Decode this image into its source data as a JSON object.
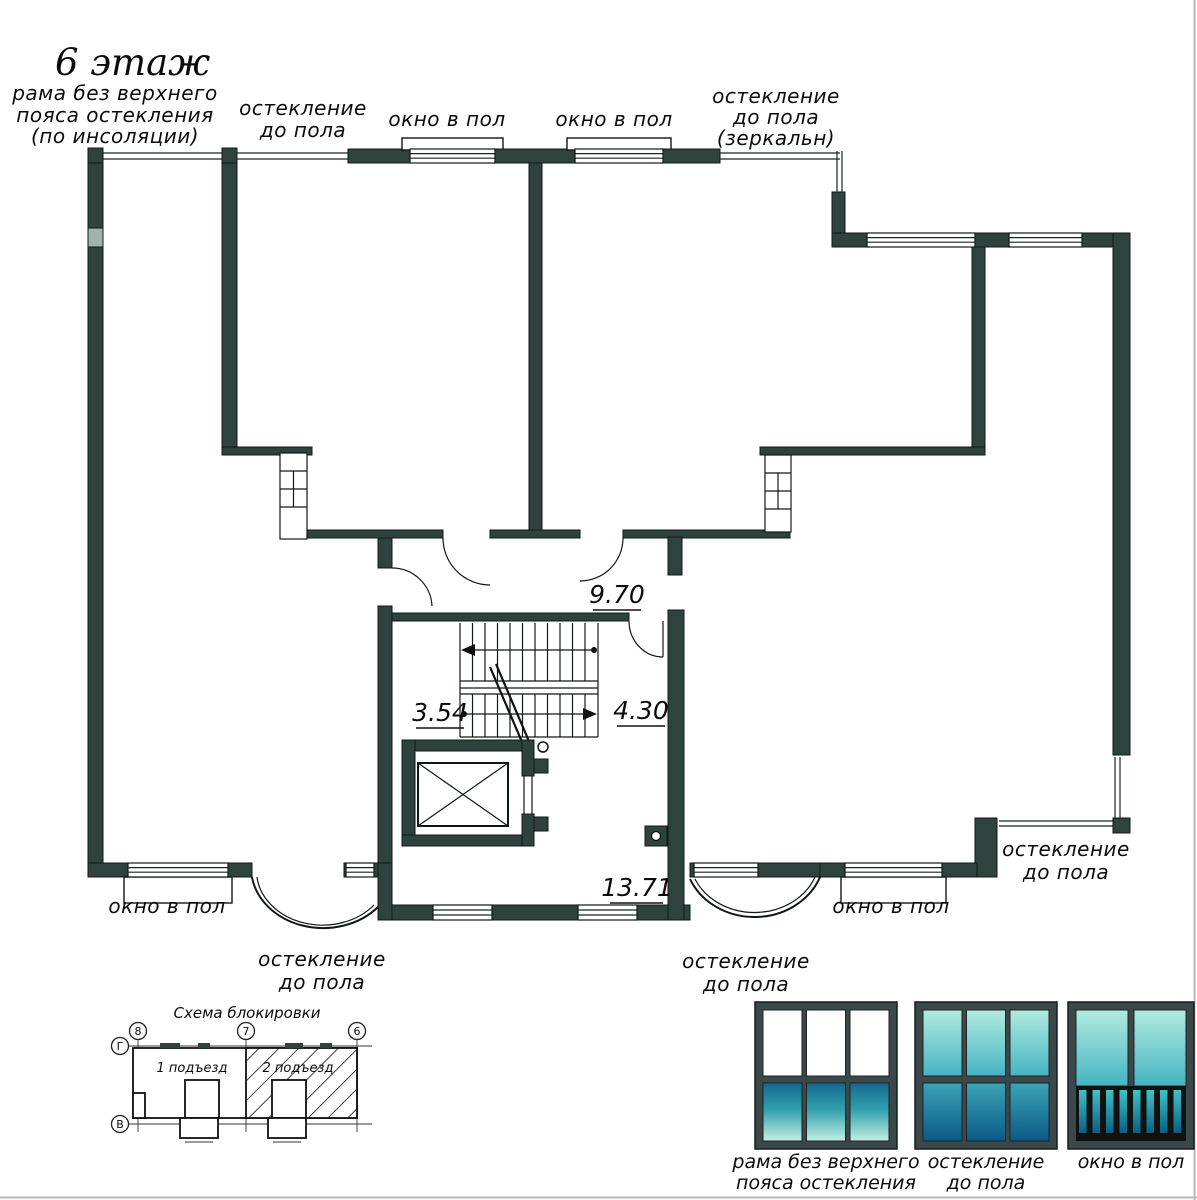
{
  "drawing": {
    "floor_title": "6 этаж",
    "annotations": {
      "frame_no_upper_belt": {
        "line1": "рама без верхнего",
        "line2": "пояса остекления",
        "line3": "(по инсоляции)"
      },
      "glazing_top_left": {
        "line1": "остекление",
        "line2": "до пола"
      },
      "window_top_left": "окно в пол",
      "window_top_right": "окно в пол",
      "glazing_mirror": {
        "line1": "остекление",
        "line2": "до пола",
        "line3": "(зеркальн)"
      },
      "window_bottom_left": "окно в пол",
      "glazing_bay_left": {
        "line1": "остекление",
        "line2": "до пола"
      },
      "glazing_bay_right": {
        "line1": "остекление",
        "line2": "до пола"
      },
      "glazing_corner_right": {
        "line1": "остекление",
        "line2": "до пола"
      },
      "window_bottom_right": "окно в пол"
    },
    "room_dimensions": {
      "corridor": "9.70",
      "under_stair": "3.54",
      "stair_side": "4.30",
      "hall": "13.71"
    }
  },
  "block_schema": {
    "title": "Схема блокировки",
    "entrance_1": "1 подъезд",
    "entrance_2": "2 подъезд",
    "axis_top_left": "8",
    "axis_top_mid": "7",
    "axis_top_right": "6",
    "axis_left_top": "Г",
    "axis_left_bottom": "В"
  },
  "legend": {
    "items": [
      {
        "line1": "рама без верхнего",
        "line2": "пояса остекления"
      },
      {
        "line1": "остекление",
        "line2": "до пола"
      },
      {
        "line1": "окно в пол",
        "line2": ""
      }
    ]
  },
  "colors": {
    "wall": "#2e433d",
    "teal_dark": "#0b5a88",
    "teal_mid": "#3fb7c4",
    "teal_light": "#bdeedd"
  }
}
